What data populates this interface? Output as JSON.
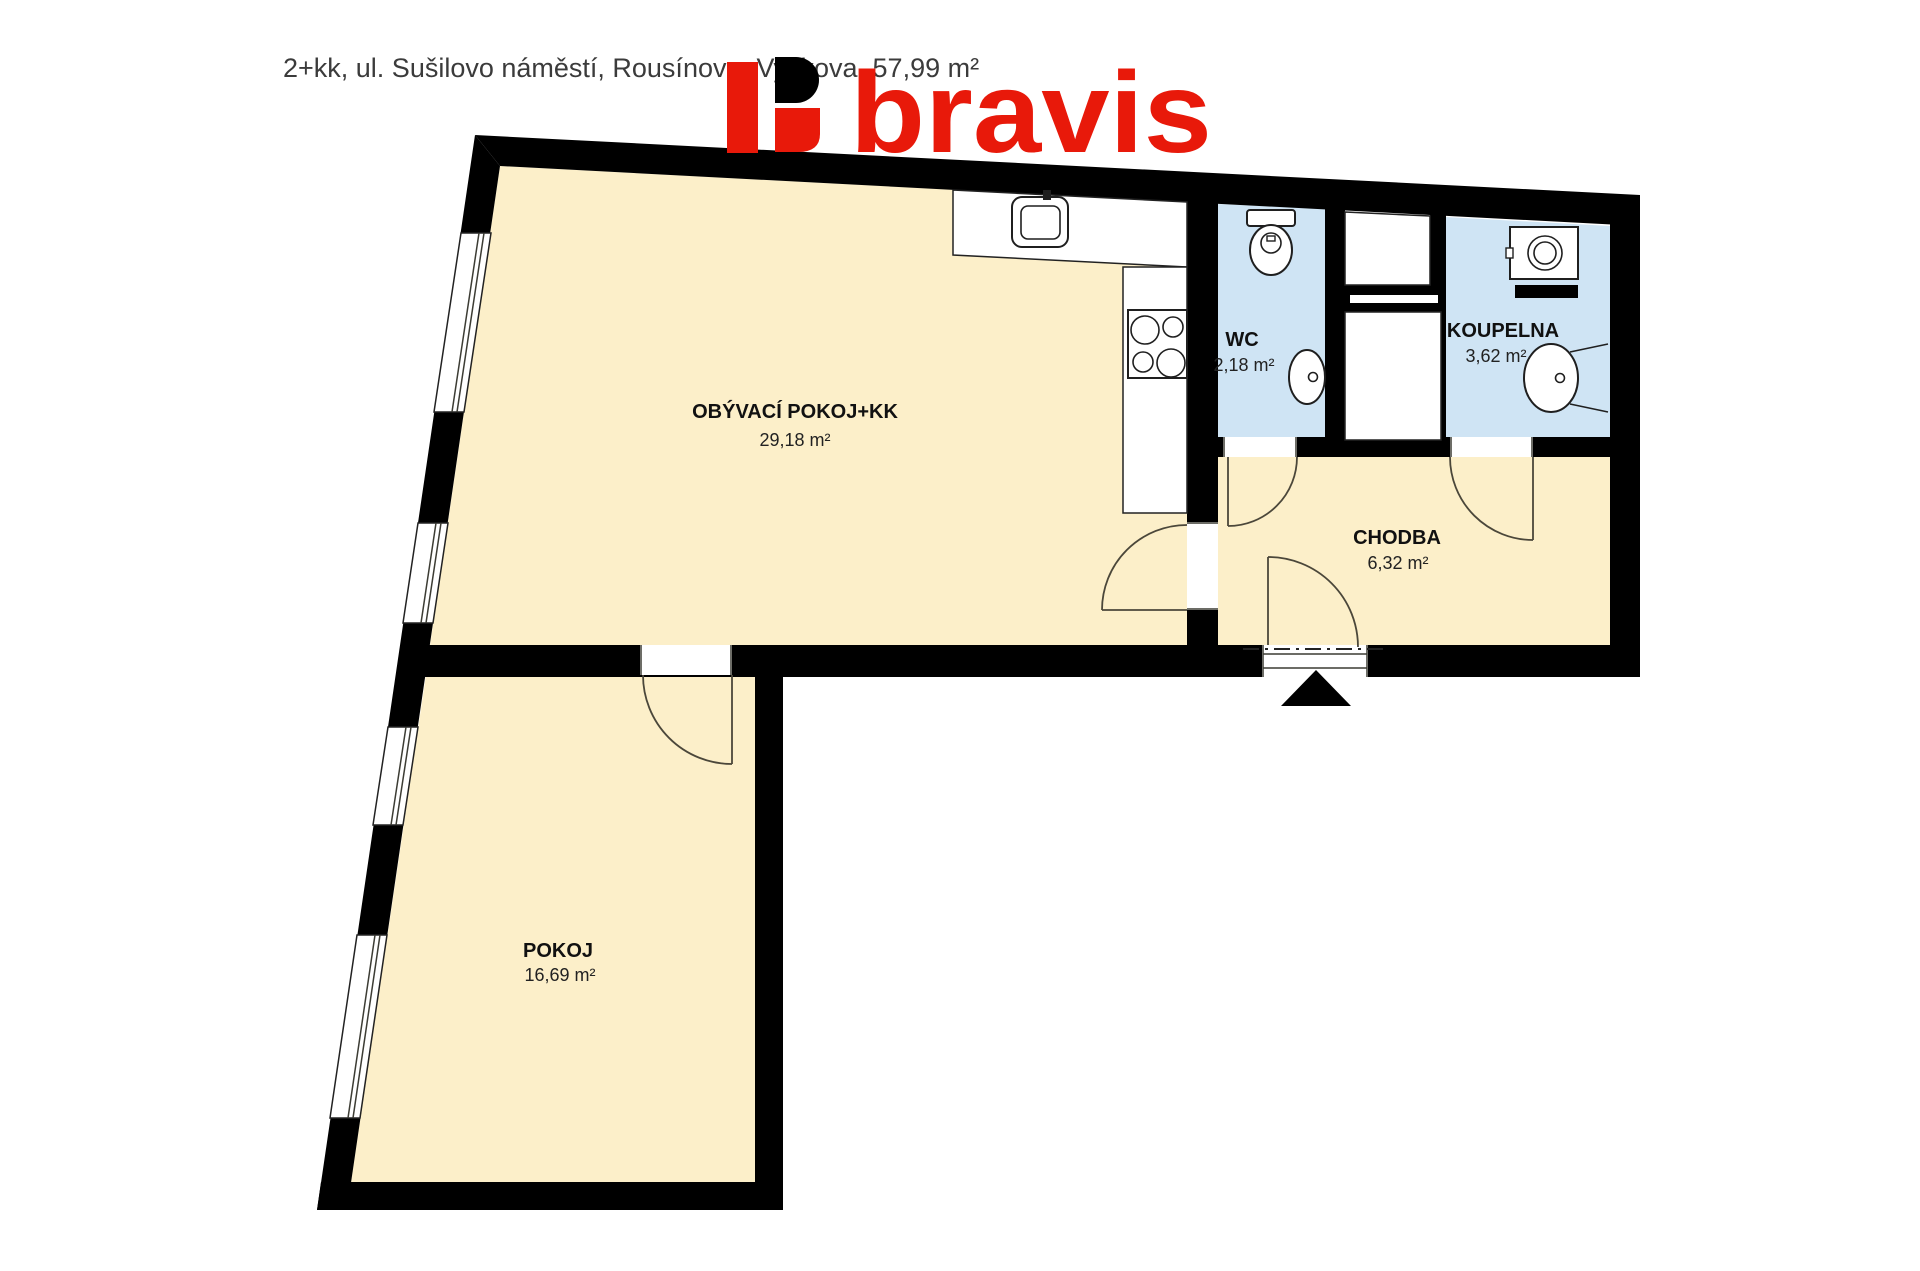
{
  "header": {
    "title": "2+kk, ul. Sušilovo náměstí, Rousínov u Vyškova, 57,99 m²"
  },
  "logo": {
    "text": "bravis",
    "color": "#e8190a"
  },
  "plan": {
    "rooms": [
      {
        "name": "OBÝVACÍ POKOJ+KK",
        "area": "29,18 m²"
      },
      {
        "name": "WC",
        "area": "2,18 m²"
      },
      {
        "name": "KOUPELNA",
        "area": "3,62 m²"
      },
      {
        "name": "CHODBA",
        "area": "6,32 m²"
      },
      {
        "name": "POKOJ",
        "area": "16,69 m²"
      }
    ],
    "colors": {
      "floor": "#fcefc9",
      "wet_floor": "#cfe4f4",
      "wall": "#000000"
    }
  }
}
